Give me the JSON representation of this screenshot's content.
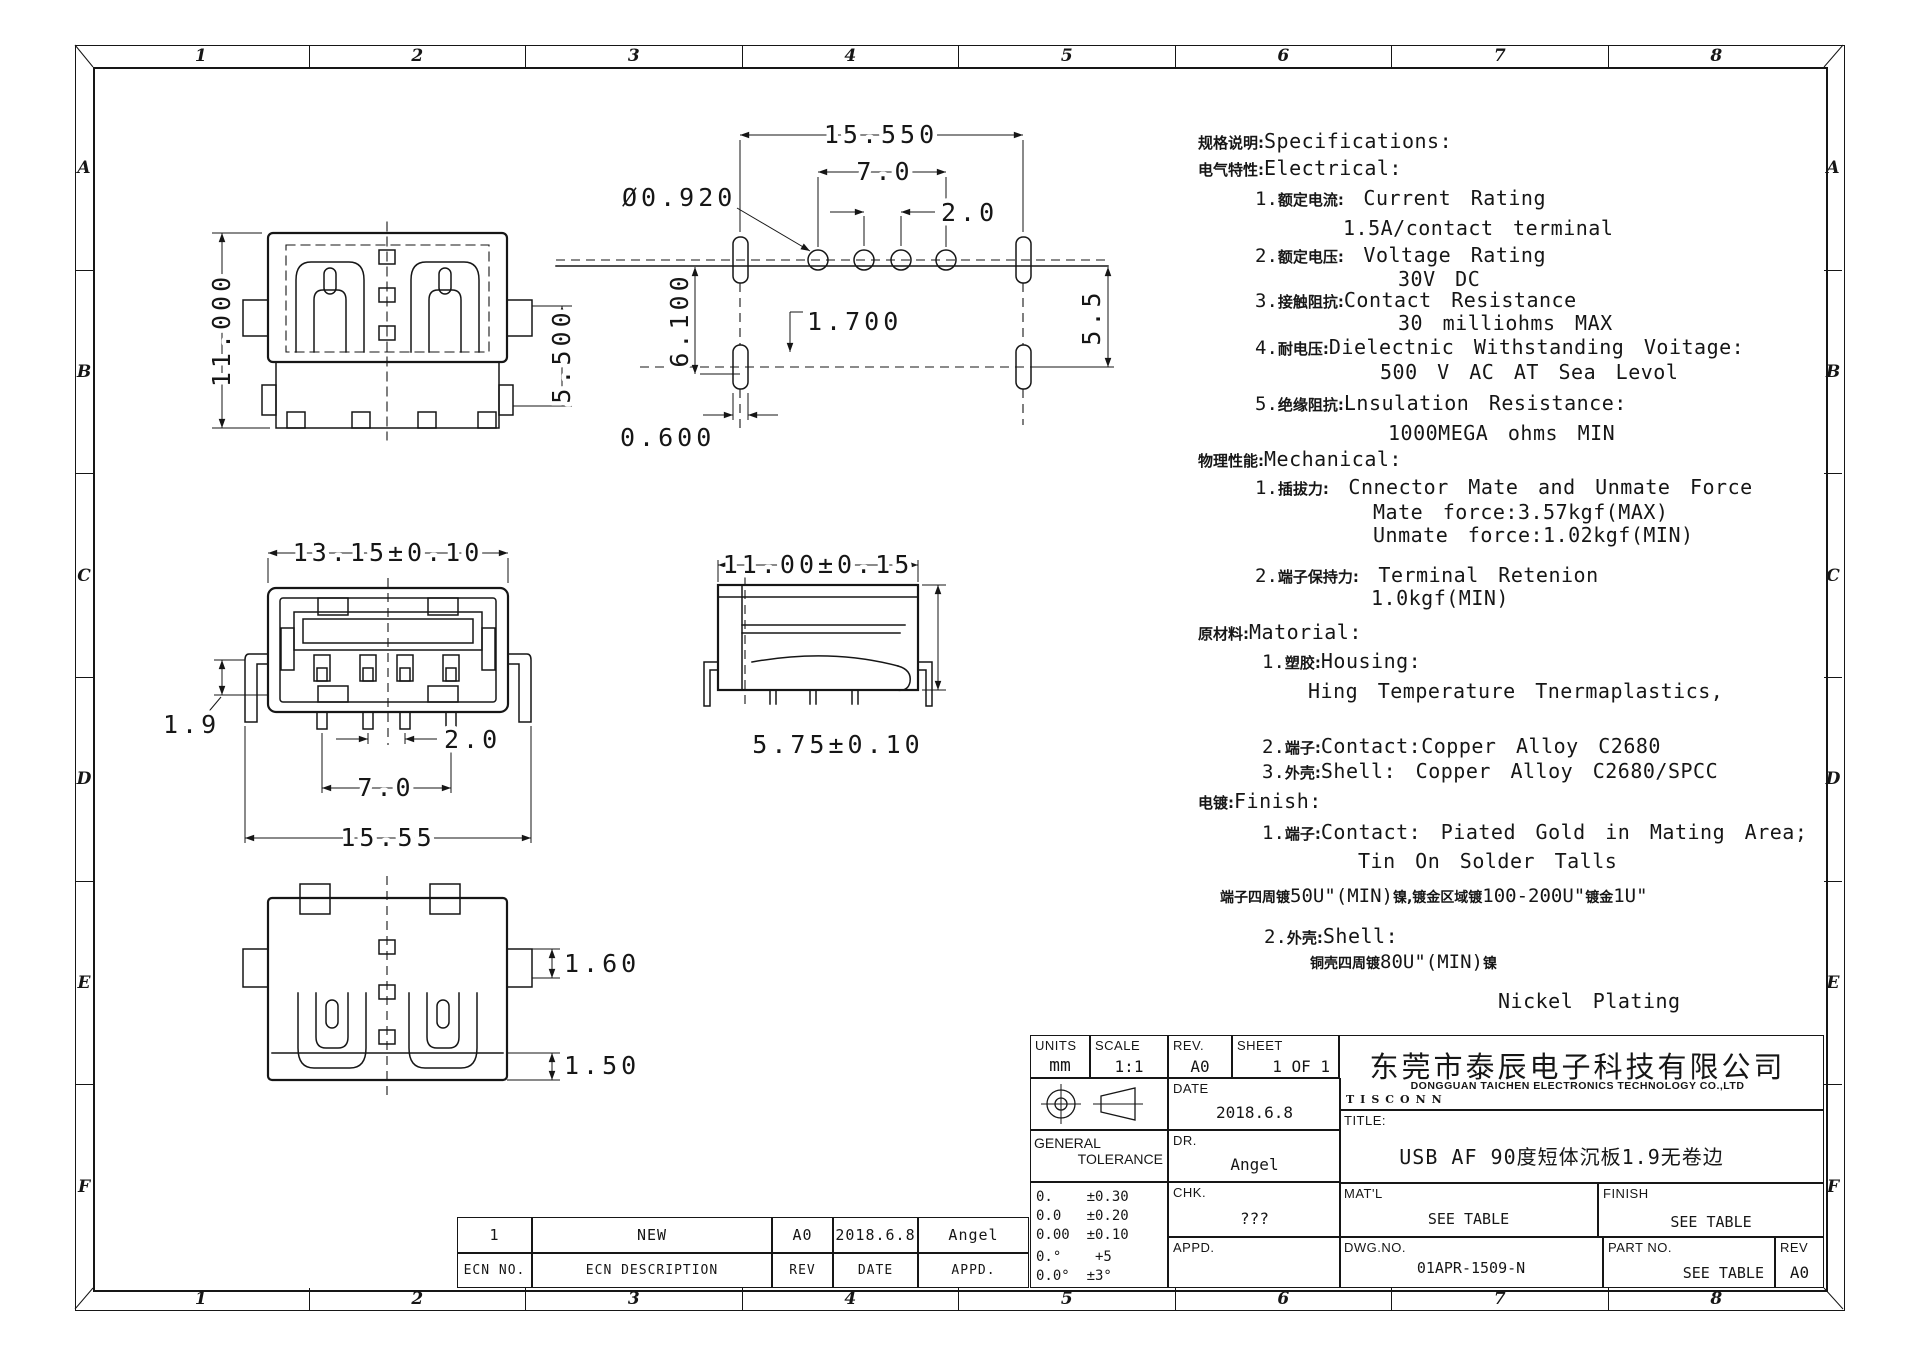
{
  "zones": {
    "cols": [
      "1",
      "2",
      "3",
      "4",
      "5",
      "6",
      "7",
      "8"
    ],
    "rows": [
      "A",
      "B",
      "C",
      "D",
      "E",
      "F"
    ]
  },
  "views": {
    "top": {
      "height": "11.000",
      "pin": "5.500"
    },
    "footprint": {
      "width": "15.550",
      "pitch_outer": "7.0",
      "pitch_inner": "2.0",
      "hole_dia": "Ø0.920",
      "depth": "6.100",
      "offset": "1.700",
      "slot": "0.600",
      "row_gap": "5.5"
    },
    "front": {
      "width": "13.15±0.10",
      "seat": "1.9",
      "pin_pitch": "2.0",
      "pin_span": "7.0",
      "leg_span": "15.55"
    },
    "side": {
      "width": "11.00±0.15",
      "height": "5.75±0.10"
    },
    "bottom": {
      "tab": "1.60",
      "foot": "1.50"
    }
  },
  "specs": {
    "lines": [
      {
        "num": "",
        "cn": "规格说明:",
        "en": "Specifications:"
      },
      {
        "num": "",
        "cn": "电气特性:",
        "en": "Electrical:"
      },
      {
        "num": "1.",
        "cn": "额定电流:",
        "en": " Current Rating"
      },
      {
        "en": "1.5A/contact terminal"
      },
      {
        "num": "2.",
        "cn": "额定电压:",
        "en": " Voltage Rating"
      },
      {
        "en": "30V DC"
      },
      {
        "num": "3.",
        "cn": "接触阻抗:",
        "en": "Contact Resistance"
      },
      {
        "en": "30 milliohms MAX"
      },
      {
        "num": "4.",
        "cn": "耐电压:",
        "en": "Dielectnic Withstanding Voitage:"
      },
      {
        "en": "500 V AC AT Sea Levol"
      },
      {
        "num": "5.",
        "cn": "绝缘阻抗:",
        "en": "Lnsulation Resistance:"
      },
      {
        "en": "1000MEGA ohms MIN"
      },
      {
        "num": "",
        "cn": "物理性能:",
        "en": "Mechanical:"
      },
      {
        "num": "1.",
        "cn": "插拔力:",
        "en": " Cnnector Mate and Unmate Force"
      },
      {
        "en": "Mate force:3.57kgf(MAX)"
      },
      {
        "en": "Unmate force:1.02kgf(MIN)"
      },
      {
        "num": "2.",
        "cn": "端子保持力:",
        "en": " Terminal Retenion"
      },
      {
        "en": "1.0kgf(MIN)"
      },
      {
        "num": "",
        "cn": "原材料:",
        "en": "Matorial:"
      },
      {
        "num": "1.",
        "cn": "塑胶:",
        "en": "Housing:"
      },
      {
        "en": "Hing Temperature  Tnermaplastics,"
      },
      {
        "num": "2.",
        "cn": "端子:",
        "en": "Contact:Copper Alloy C2680"
      },
      {
        "num": "3.",
        "cn": "外壳:",
        "en": "Shell: Copper Alloy C2680/SPCC"
      },
      {
        "num": "",
        "cn": "电镀:",
        "en": "Finish:"
      },
      {
        "num": "1.",
        "cn": "端子:",
        "en": "Contact: Piated Gold in Mating Area;"
      },
      {
        "en": "Tin On Solder Talls"
      },
      {
        "seg": {
          "cn1": "端子四周镀",
          "en1": "50U\"(MIN)",
          "cn2": "镍,镀金区域镀",
          "en2": "100-200U\"",
          "cn3": "镀金",
          "en3": "1U\""
        }
      },
      {
        "num": "2.",
        "cn": "外壳:",
        "en": "Shell:"
      },
      {
        "seg": {
          "cn1": "铜壳四周镀",
          "en1": "80U\"(MIN)",
          "cn2": "镍"
        }
      },
      {
        "en": "Nickel Plating"
      }
    ]
  },
  "ecn": {
    "row": {
      "no": "1",
      "desc": "NEW",
      "rev": "A0",
      "date": "2018.6.8",
      "appd": "Angel"
    },
    "header": {
      "no": "ECN NO.",
      "desc": "ECN DESCRIPTION",
      "rev": "REV",
      "date": "DATE",
      "appd": "APPD."
    }
  },
  "title_block": {
    "units_label": "UNITS",
    "units": "mm",
    "scale_label": "SCALE",
    "scale": "1:1",
    "rev_label": "REV.",
    "rev": "A0",
    "sheet_label": "SHEET",
    "sheet": "1 OF 1",
    "date_label": "DATE",
    "date": "2018.6.8",
    "general_tolerance_1": "GENERAL",
    "general_tolerance_2": "TOLERANCE",
    "dr_label": "DR.",
    "dr": "Angel",
    "tolerances": [
      "0.    ±0.30",
      "0.0   ±0.20",
      "0.00  ±0.10",
      "0.°    +5",
      "0.0°  ±3°"
    ],
    "chk_label": "CHK.",
    "chk": "???",
    "appd_label": "APPD.",
    "appd": "",
    "company_cn": "东莞市泰辰电子科技有限公司",
    "company_en": "DONGGUAN  TAICHEN  ELECTRONICS  TECHNOLOGY  CO.,LTD",
    "logo": "TISCONN",
    "title_label": "TITLE:",
    "title": "USB  AF  90度短体沉板1.9无卷边",
    "matl_label": "MAT'L",
    "matl": "SEE TABLE",
    "finish_label": "FINISH",
    "finish": "SEE TABLE",
    "dwg_label": "DWG.NO.",
    "dwg_no": "01APR-1509-N",
    "part_label": "PART NO.",
    "part_no": "SEE TABLE",
    "rev2_label": "REV",
    "rev2": "A0"
  }
}
